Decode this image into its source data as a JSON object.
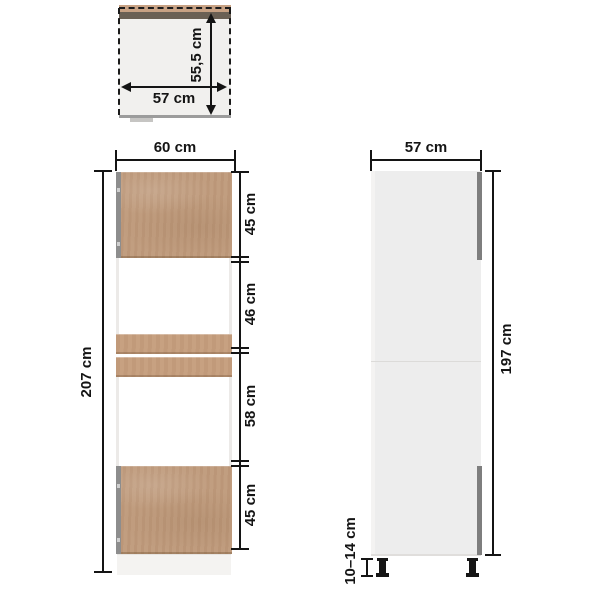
{
  "diagram": {
    "top_view": {
      "width_label": "57 cm",
      "depth_label": "55,5 cm"
    },
    "front_view": {
      "width_label": "60 cm",
      "height_label": "207 cm",
      "section_labels": [
        "45 cm",
        "46 cm",
        "58 cm",
        "45 cm"
      ]
    },
    "side_view": {
      "depth_label": "57 cm",
      "body_height_label": "197 cm",
      "feet_height_label": "10–14 cm"
    },
    "colors": {
      "wood": "#bf9a7b",
      "wood_rail": "#c59d7c",
      "top_edge_dark": "#6a6054",
      "top_edge_wood": "#c7a183",
      "side_panel": "#ededed",
      "hinge_strip": "#8d8d8d",
      "door_edge_strip": "#7e7e7e",
      "dimension_ink": "#141414"
    }
  }
}
